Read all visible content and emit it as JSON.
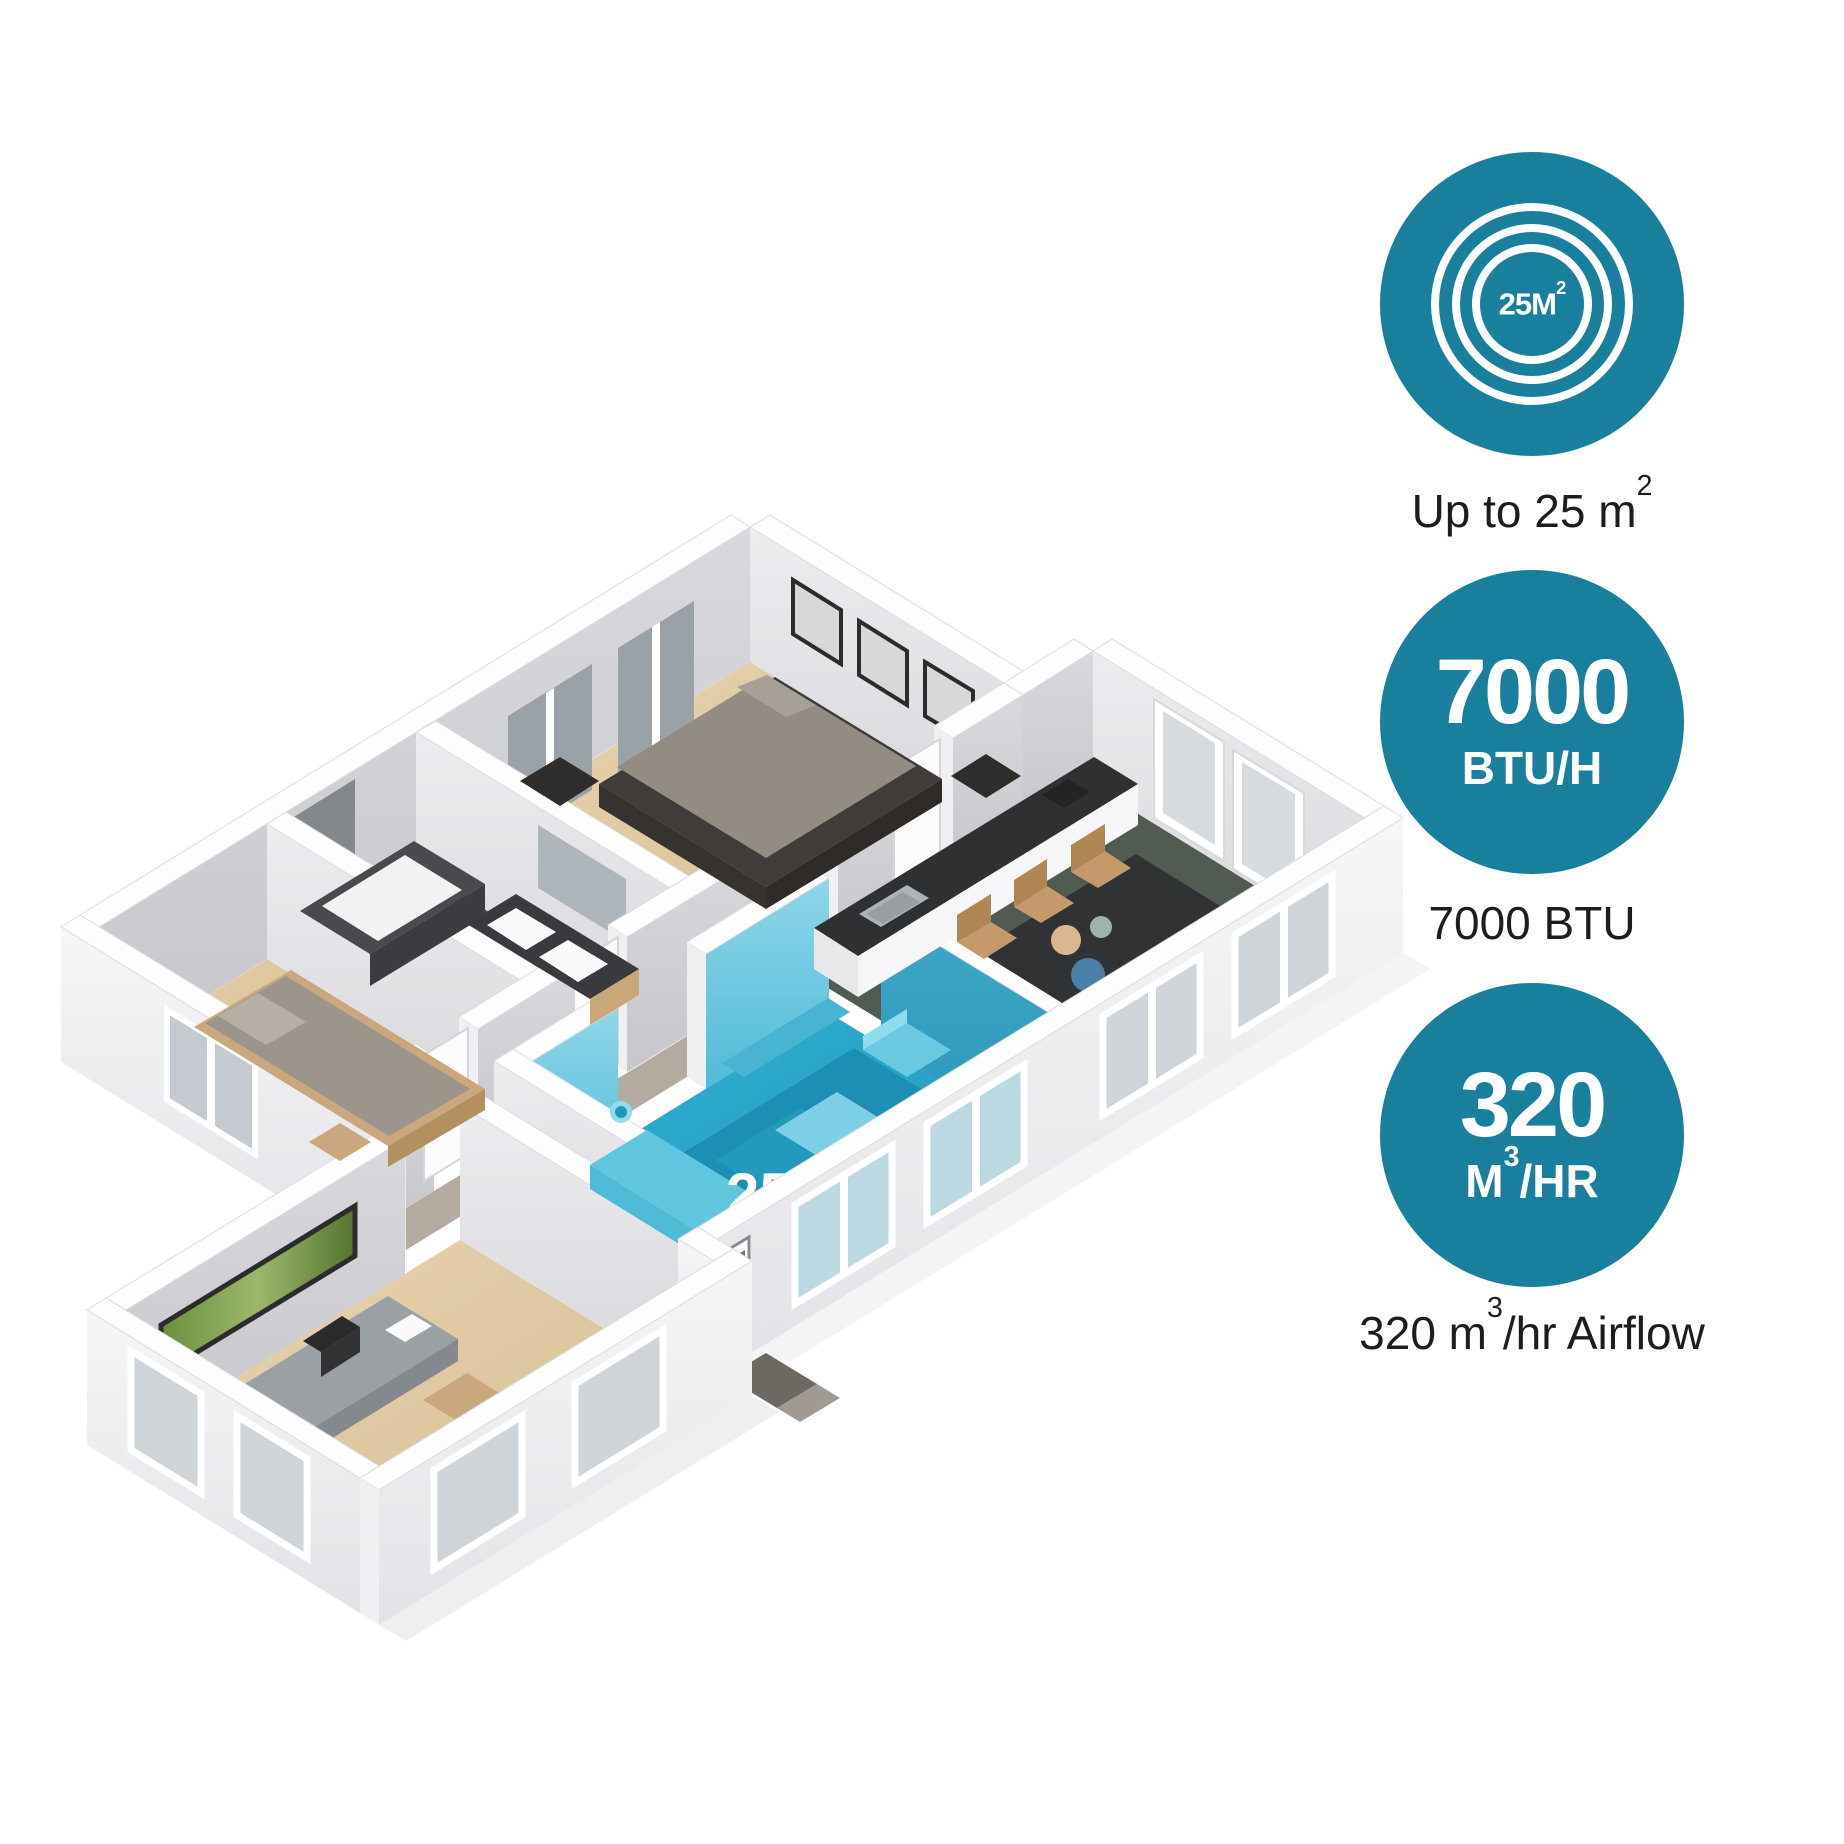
{
  "accent_color": "#187F9D",
  "floor_plan": {
    "highlight_color": "#29A9CD",
    "highlight_room_label": {
      "value": "25 m",
      "sup": "2"
    }
  },
  "badges": {
    "coverage": {
      "icon_value": "25M",
      "icon_sup": "2",
      "caption_pre": "Up to 25 m",
      "caption_sup": "2",
      "caption_post": ""
    },
    "cooling": {
      "line1": "7000",
      "line2": "BTU/H",
      "caption": "7000 BTU"
    },
    "airflow": {
      "line1": "320",
      "line2_pre": "M",
      "line2_sup": "3",
      "line2_post": "/HR",
      "caption_pre": "320 m",
      "caption_sup": "3",
      "caption_post": "/hr Airflow"
    }
  }
}
